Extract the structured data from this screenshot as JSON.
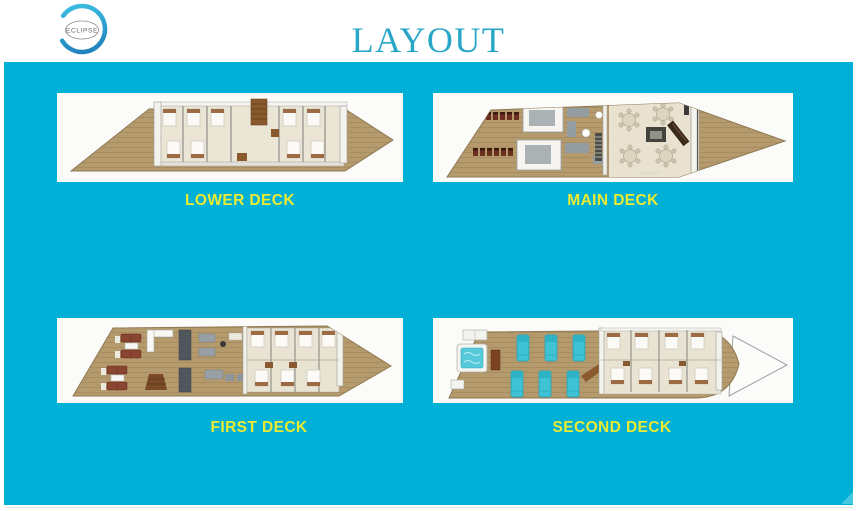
{
  "brand": {
    "name": "ECLIPSE"
  },
  "header": {
    "title": "LAYOUT"
  },
  "colors": {
    "panel_background": "#00b0d6",
    "deck_label_yellow": "#eceb33",
    "title_teal": "#29a6c7",
    "card_background": "#fbfbfa",
    "wood": "#b59a6d",
    "logo_blue": "#1d77b8",
    "logo_cyan": "#3fc6e6",
    "lounger_cyan": "#3fc3d4"
  },
  "decks": [
    {
      "id": "lower-deck",
      "label": "LOWER DECK"
    },
    {
      "id": "main-deck",
      "label": "MAIN DECK"
    },
    {
      "id": "first-deck",
      "label": "FIRST DECK"
    },
    {
      "id": "second-deck",
      "label": "SECOND DECK"
    }
  ]
}
